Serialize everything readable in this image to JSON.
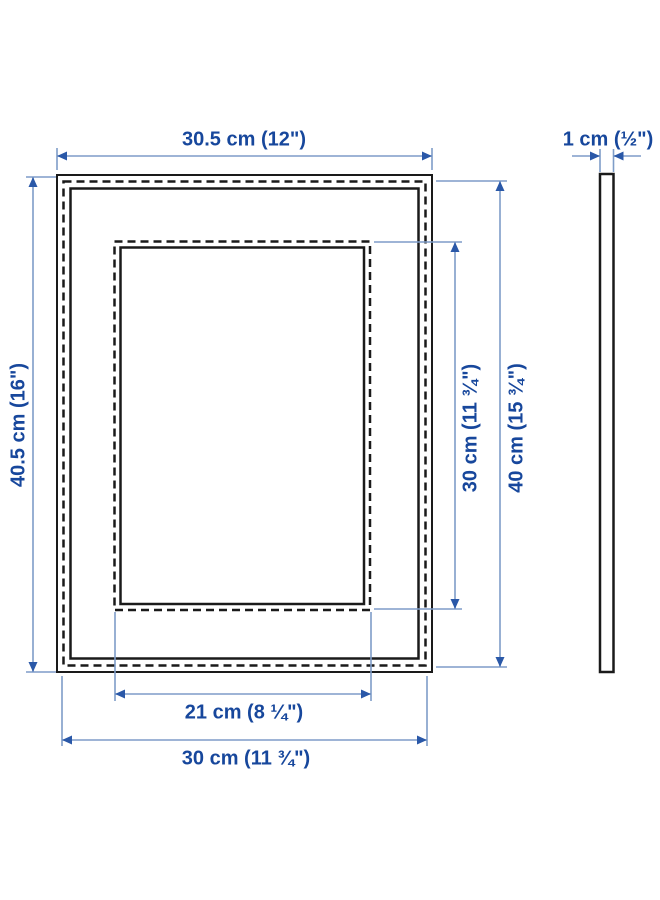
{
  "diagram_name": "picture-frame-dimension-diagram",
  "colors": {
    "label_text": "#17479c",
    "dimension_line": "#7e9cc8",
    "dimension_arrow": "#2a58a8",
    "drawing_outline": "#1a1a1a",
    "background": "#ffffff"
  },
  "dimensions": {
    "outer_width": "30.5 cm (12\")",
    "outer_height": "40.5 cm (16\")",
    "picture_width": "30 cm (11 ¾\")",
    "picture_height": "40 cm (15 ¾\")",
    "opening_width": "21 cm (8 ¼\")",
    "opening_height": "30 cm (11 ¾\")",
    "depth": "1 cm (½\")"
  }
}
